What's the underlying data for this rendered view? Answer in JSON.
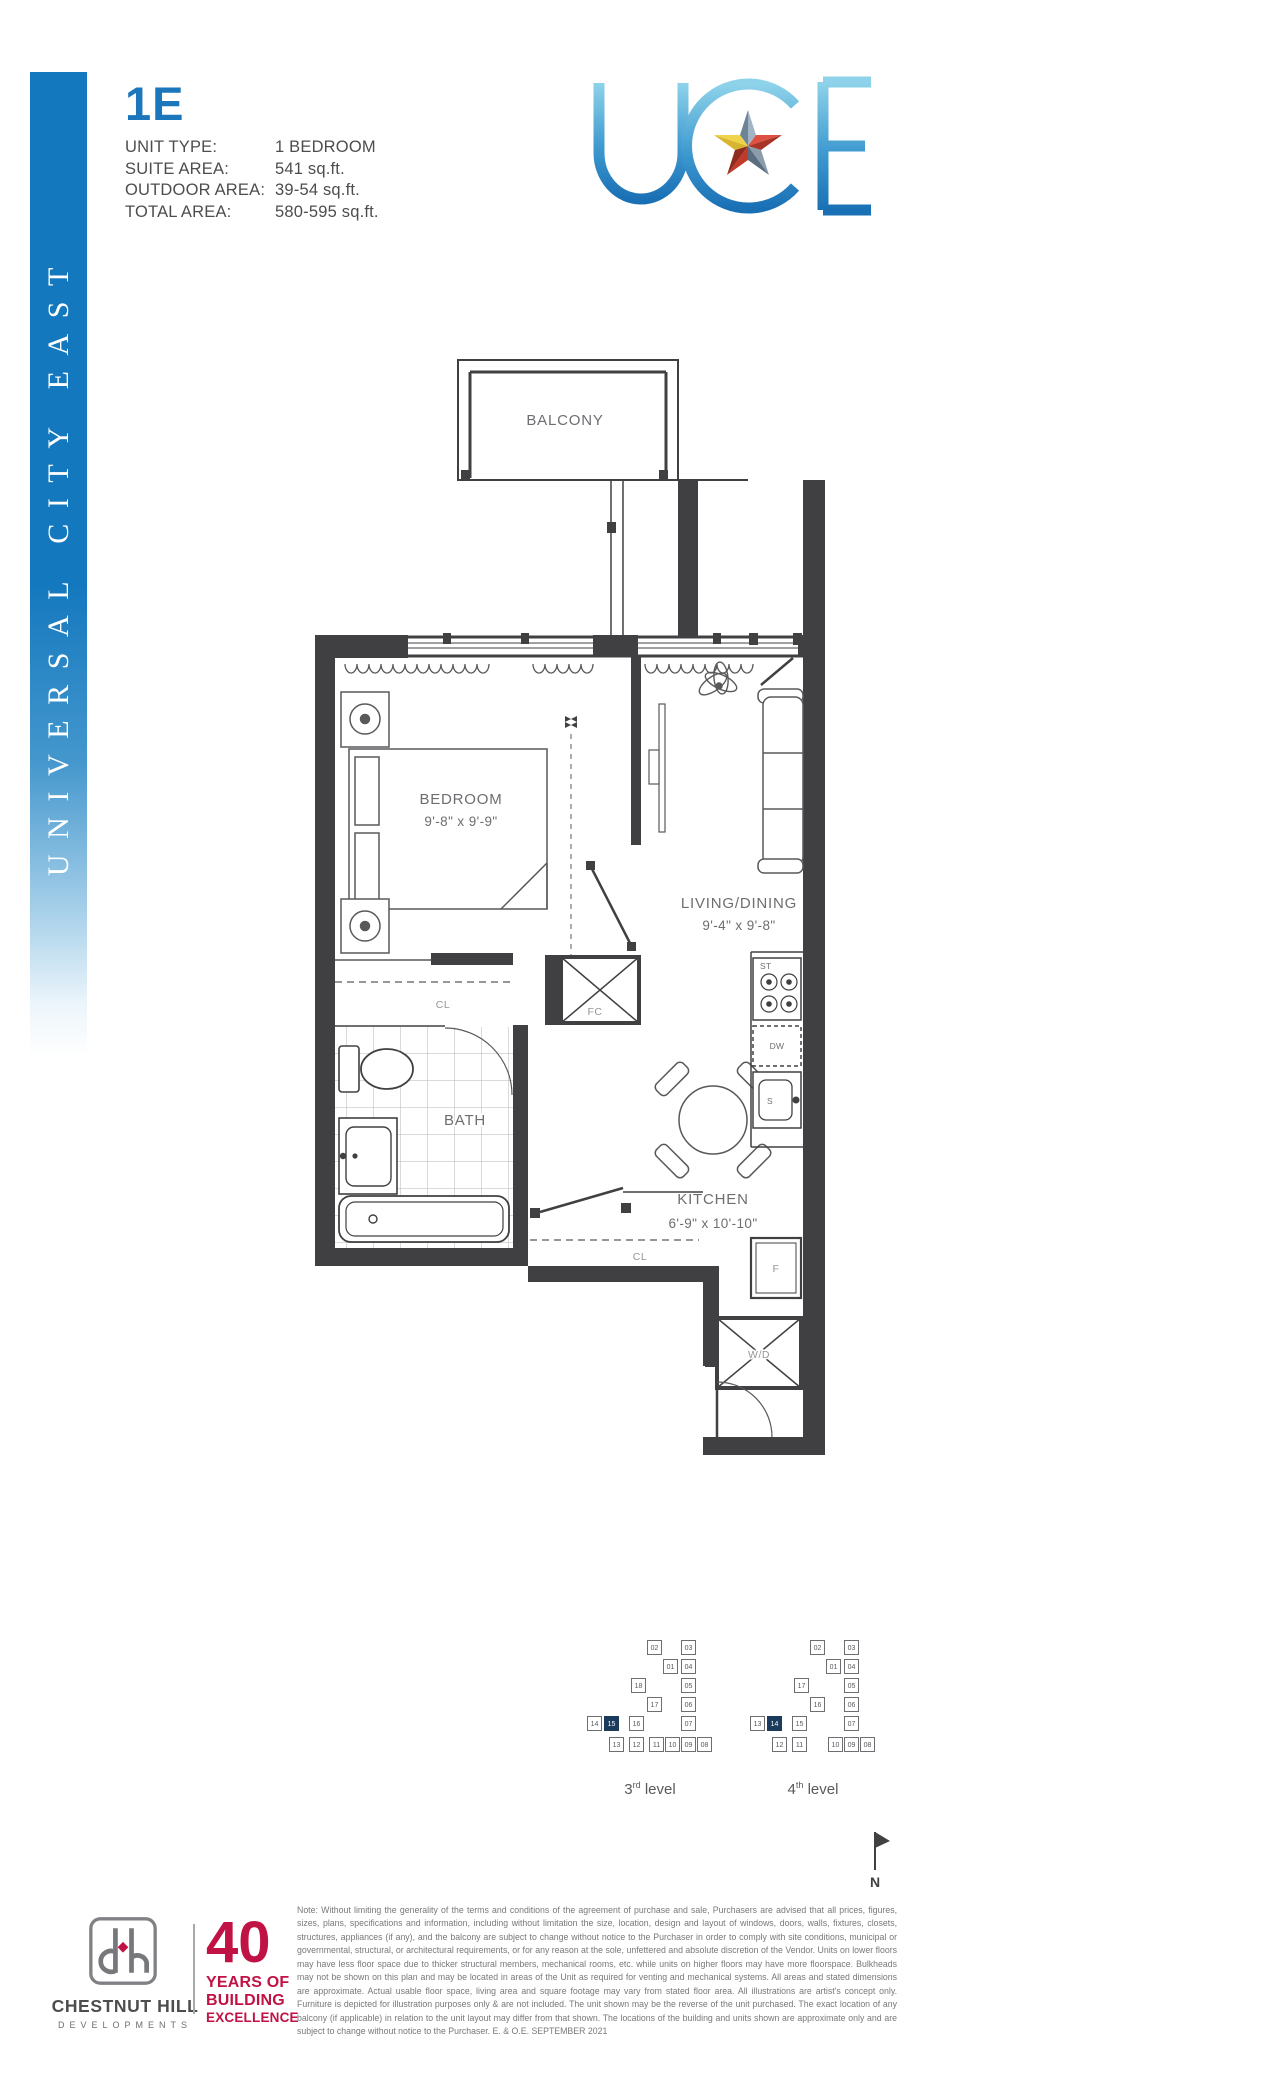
{
  "sidebar": {
    "text": "UNIVERSAL CITY EAST",
    "color": "#1478be"
  },
  "header": {
    "unit_code": "1E",
    "accent": "#1b76bc",
    "details": [
      {
        "label": "UNIT TYPE:",
        "value": "1 BEDROOM"
      },
      {
        "label": "SUITE AREA:",
        "value": "541 sq.ft."
      },
      {
        "label": "OUTDOOR AREA:",
        "value": "39-54 sq.ft."
      },
      {
        "label": "TOTAL AREA:",
        "value": "580-595 sq.ft."
      }
    ]
  },
  "logo": {
    "letters": "UCE",
    "gradient_top": "#8ed3ea",
    "gradient_bottom": "#1a70b5"
  },
  "floorplan": {
    "balcony": "BALCONY",
    "bedroom": {
      "name": "BEDROOM",
      "dims": "9'-8\" x 9'-9\""
    },
    "living": {
      "name": "LIVING/DINING",
      "dims": "9'-4\" x 9'-8\""
    },
    "kitchen": {
      "name": "KITCHEN",
      "dims": "6'-9\" x 10'-10\""
    },
    "bath": "BATH",
    "closet1": "CL",
    "closet2": "CL",
    "fan_coil": "FC",
    "washer_dryer": "W/D",
    "appliances": {
      "stove": "ST",
      "dishwasher": "DW",
      "sink": "S",
      "fridge": "F"
    }
  },
  "keyplans": [
    {
      "caption_num": "3",
      "caption_sup": "rd",
      "caption_rest": " level",
      "highlighted": "15",
      "cells": [
        {
          "n": "02"
        },
        {
          "n": "03"
        },
        {
          "n": "01"
        },
        {
          "n": "04"
        },
        {
          "n": "18"
        },
        {
          "n": "05"
        },
        {
          "n": "17"
        },
        {
          "n": "06"
        },
        {
          "n": "14"
        },
        {
          "n": "15"
        },
        {
          "n": "16"
        },
        {
          "n": "07"
        },
        {
          "n": "13"
        },
        {
          "n": "12"
        },
        {
          "n": "11"
        },
        {
          "n": "10"
        },
        {
          "n": "09"
        },
        {
          "n": "08"
        }
      ]
    },
    {
      "caption_num": "4",
      "caption_sup": "th",
      "caption_rest": " level",
      "highlighted": "14",
      "cells": [
        {
          "n": "02"
        },
        {
          "n": "03"
        },
        {
          "n": "01"
        },
        {
          "n": "04"
        },
        {
          "n": "17"
        },
        {
          "n": "05"
        },
        {
          "n": "16"
        },
        {
          "n": "06"
        },
        {
          "n": "13"
        },
        {
          "n": "14"
        },
        {
          "n": "15"
        },
        {
          "n": "07"
        },
        {
          "n": "12"
        },
        {
          "n": "11"
        },
        {
          "n": "10"
        },
        {
          "n": "09"
        },
        {
          "n": "08"
        }
      ]
    }
  ],
  "compass": {
    "label": "N"
  },
  "footer": {
    "developer": {
      "name": "CHESTNUT HILL",
      "sub": "DEVELOPMENTS"
    },
    "badge": {
      "num": "40",
      "line1": "YEARS OF",
      "line2": "BUILDING",
      "line3": "EXCELLENCE",
      "color": "#c01244"
    },
    "note": "Note: Without limiting the generality of the terms and conditions of the agreement of purchase and sale, Purchasers are advised that all prices, figures, sizes, plans, specifications and information, including without limitation the size, location, design and layout of windows, doors, walls, fixtures, closets, structures, appliances (if any), and the balcony are subject to change without notice to the Purchaser in order to comply with site conditions, municipal or governmental, structural, or architectural requirements, or for any reason at the sole, unfettered and absolute discretion of the Vendor. Units on lower floors may have less floor space due to thicker structural members, mechanical rooms, etc. while units on higher floors may have more floorspace. Bulkheads may not be shown on this plan and may be located in areas of the Unit as required for venting and mechanical systems. All areas and stated dimensions are approximate. Actual usable floor space, living area and square footage may vary from stated floor area. All illustrations are artist's concept only. Furniture is depicted for illustration purposes only & are not included. The unit shown may be the reverse of the unit purchased. The exact location of any balcony (if applicable) in relation to the unit layout may differ from that shown. The locations of the building and units shown are approximate only and are subject to change without notice to the Purchaser. E. & O.E. SEPTEMBER 2021"
  }
}
